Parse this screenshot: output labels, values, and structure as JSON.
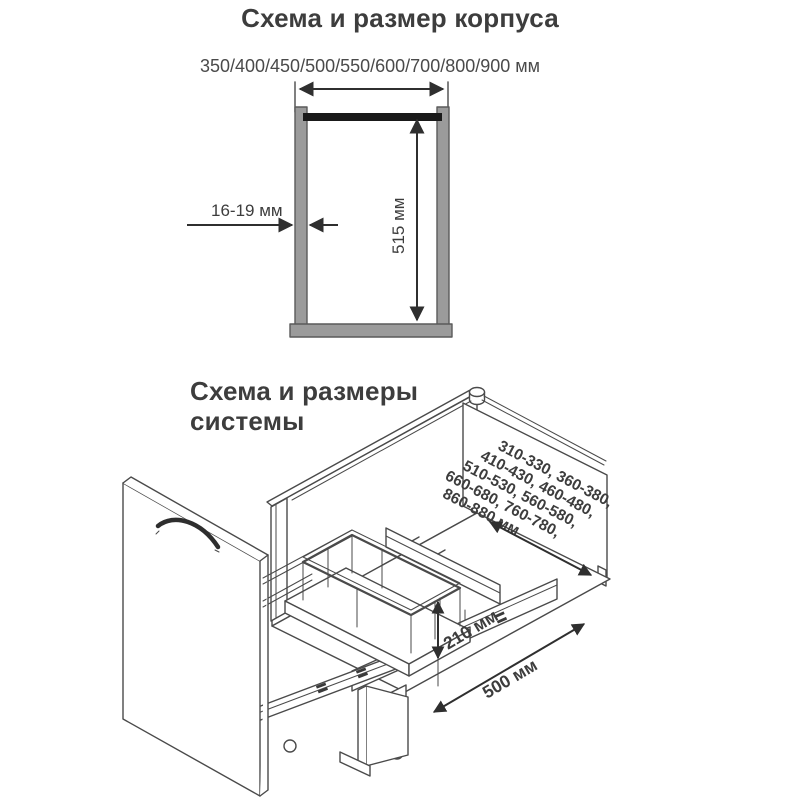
{
  "cabinet_section": {
    "title": "Схема и размер корпуса",
    "width_options_label": "350/400/450/500/550/600/700/800/900 мм",
    "panel_thickness_label": "16-19 мм",
    "inner_height_label": "515 мм"
  },
  "system_section": {
    "title_line1": "Схема и размеры",
    "title_line2": "системы",
    "depth_options_lines": [
      "310-330, 360-380,",
      "410-430, 460-480,",
      "510-530, 560-580,",
      "660-680, 760-780,",
      "860-880 мм"
    ],
    "height_label": "210 мм",
    "length_label": "500 мм"
  },
  "colors": {
    "background": "#ffffff",
    "line": "#4a4a4a",
    "text": "#3d3d3d",
    "wall_fill": "#9b9b9b",
    "top_rail_fill": "#1a1a1a"
  }
}
